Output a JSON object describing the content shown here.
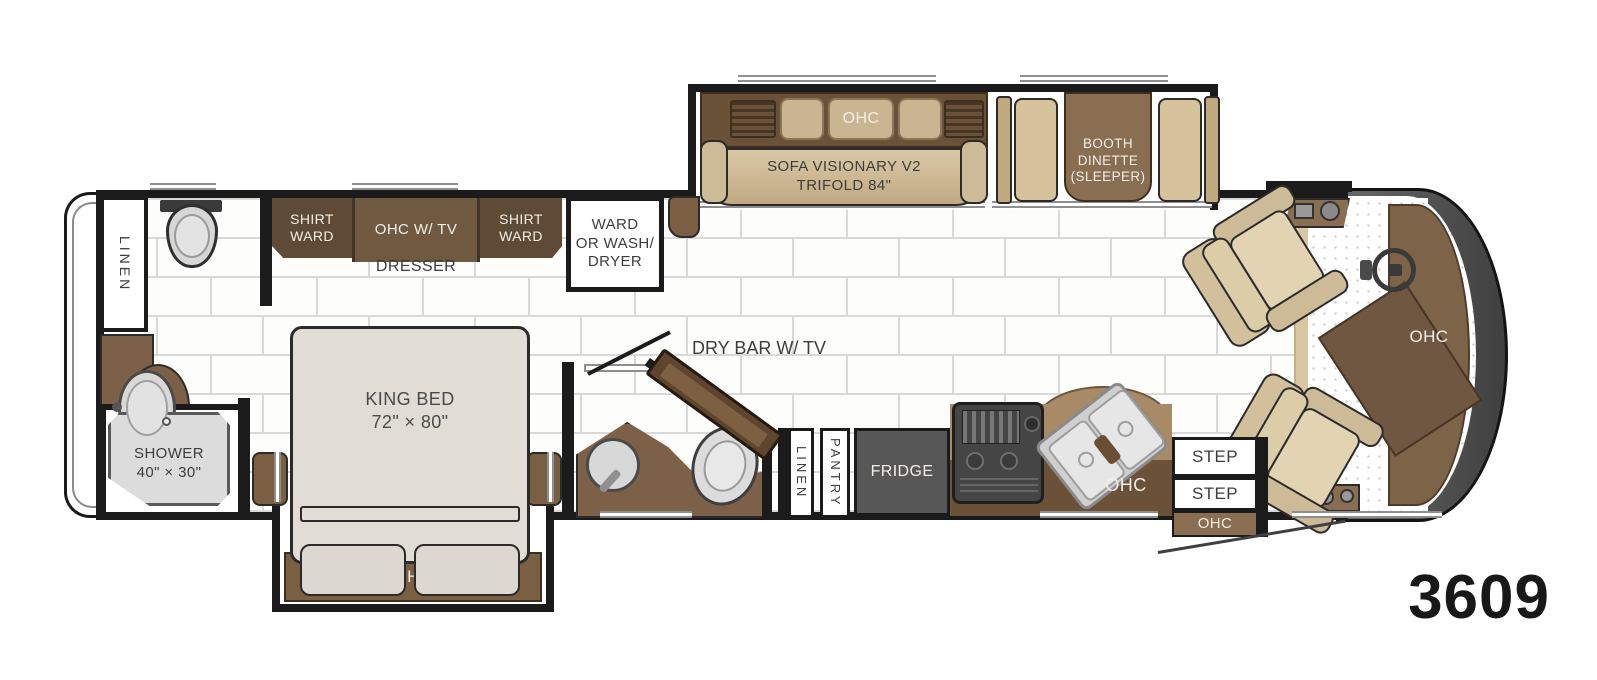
{
  "model_number": "3609",
  "colors": {
    "wall": "#1b1b1b",
    "cabinet_dark_brown": "#5e4a37",
    "cabinet_mid_brown": "#7b5f43",
    "counter_brown": "#a88a66",
    "tan_furniture": "#d9c7a4",
    "fridge_gray": "#575757",
    "floor_grout": "#d9d9d9"
  },
  "rear_bath": {
    "linen": "LINEN",
    "shower_line1": "SHOWER",
    "shower_line2": "40\" × 30\""
  },
  "bedroom": {
    "shirt_ward_left_line1": "SHIRT",
    "shirt_ward_left_line2": "WARD",
    "ohc_tv": "OHC W/ TV",
    "shirt_ward_right_line1": "SHIRT",
    "shirt_ward_right_line2": "WARD",
    "dresser": "DRESSER",
    "ward_wd_line1": "WARD",
    "ward_wd_line2": "OR WASH/",
    "ward_wd_line3": "DRYER",
    "king_line1": "KING BED",
    "king_line2": "72\" × 80\"",
    "bed_ohc": "OHC"
  },
  "living": {
    "sofa_ohc": "OHC",
    "sofa_line1": "SOFA VISIONARY V2",
    "sofa_line2": "TRIFOLD 84\"",
    "booth_line1": "BOOTH",
    "booth_line2": "DINETTE",
    "booth_line3": "(SLEEPER)",
    "dry_bar": "DRY BAR W/ TV"
  },
  "hall": {
    "linen": "LINEN",
    "pantry": "PANTRY"
  },
  "kitchen": {
    "fridge": "FRIDGE",
    "ohc": "OHC"
  },
  "entry": {
    "step1": "STEP",
    "step2": "STEP",
    "ohc": "OHC"
  },
  "cockpit": {
    "dash_ohc": "OHC"
  }
}
